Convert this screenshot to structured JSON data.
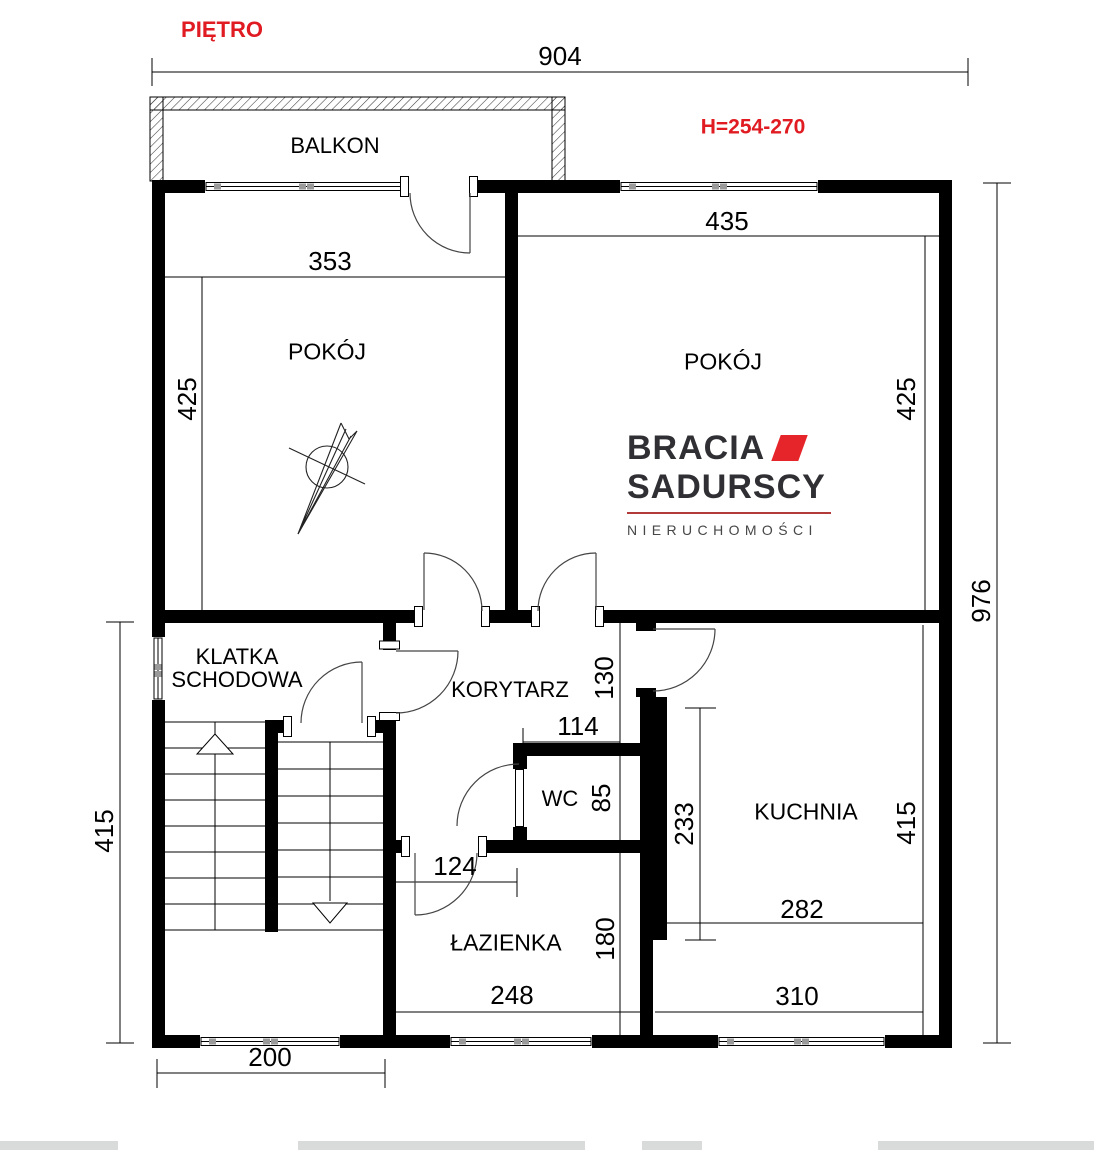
{
  "title": {
    "floor_label": "PIĘTRO",
    "height_label": "H=254-270"
  },
  "colors": {
    "accent_red": "#e01b21",
    "wall_black": "#000000",
    "logo_dark": "#302f33",
    "logo_red": "#e52529",
    "logo_rule_red": "#b23b39",
    "logo_gray": "#474747",
    "window_mullion_gray": "#9a9a9a"
  },
  "rooms": {
    "balcony": "BALKON",
    "room_left": "POKÓJ",
    "room_right": "POKÓJ",
    "staircase_line1": "KLATKA",
    "staircase_line2": "SCHODOWA",
    "corridor": "KORYTARZ",
    "wc": "WC",
    "kitchen": "KUCHNIA",
    "bathroom": "ŁAZIENKA"
  },
  "dimensions": {
    "total_width": "904",
    "total_height": "976",
    "room_left_width": "353",
    "room_left_height": "425",
    "room_right_width": "435",
    "room_right_height": "425",
    "staircase_side_height": "415",
    "corridor_depth": "130",
    "wc_width": "114",
    "wc_depth": "85",
    "kitchen_wall_length": "233",
    "kitchen_inner_width": "282",
    "kitchen_height": "415",
    "bathroom_door_offset": "124",
    "bathroom_depth": "180",
    "bathroom_width": "248",
    "kitchen_bottom_width": "310",
    "staircase_bottom_width": "200"
  },
  "logo": {
    "line1": "BRACIA",
    "line2": "SADURSCY",
    "line3": "NIERUCHOMOŚCI"
  }
}
